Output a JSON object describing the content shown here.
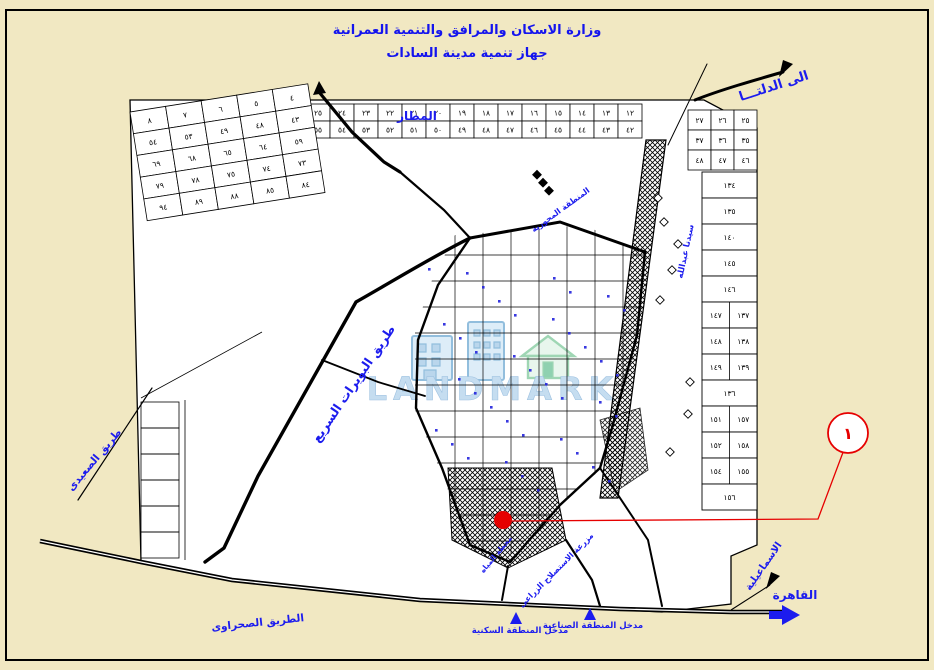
{
  "colors": {
    "bg": "#f1e8c2",
    "line": "#000000",
    "label": "#1c1cee",
    "title": "#1414ee",
    "red": "#e60000",
    "watermark_blue": "#aecfe9",
    "watermark_blue_stroke": "#7fb3d8",
    "watermark_green": "#7cc9a3"
  },
  "header": {
    "line1": "وزارة الاسكان والمرافق والتنمية العمرانية",
    "line2": "جهاز تنمية مدينة السادات"
  },
  "watermark": {
    "text": "LANDMARK"
  },
  "marker": {
    "dot": {
      "x": 503,
      "y": 520,
      "r": 9
    },
    "leader": [
      [
        512,
        521
      ],
      [
        818,
        519
      ],
      [
        845,
        447
      ]
    ],
    "circle": {
      "x": 848,
      "y": 433,
      "r": 20,
      "label": "١"
    }
  },
  "map": {
    "labels": [
      {
        "id": "airport",
        "text": "المطار",
        "x": 417,
        "y": 120,
        "size": 12,
        "rotate": 0
      },
      {
        "id": "to-delta",
        "text": "الى الدلتـــا",
        "x": 775,
        "y": 90,
        "size": 13,
        "rotate": -18
      },
      {
        "id": "cairo",
        "text": "القاهرة",
        "x": 795,
        "y": 599,
        "size": 12,
        "rotate": 0
      },
      {
        "id": "ismailia",
        "text": "الاسماعيلية",
        "x": 766,
        "y": 568,
        "size": 10,
        "rotate": -55
      },
      {
        "id": "desert-road",
        "text": "الطريق الصحراوى",
        "x": 258,
        "y": 626,
        "size": 10.5,
        "rotate": -6
      },
      {
        "id": "saeedi-road",
        "text": "طريق الصعيدى",
        "x": 97,
        "y": 462,
        "size": 10.5,
        "rotate": -50
      },
      {
        "id": "buwayrat-road",
        "text": "طريق البويرات السريع",
        "x": 357,
        "y": 386,
        "size": 12.5,
        "rotate": -56
      },
      {
        "id": "central-zone",
        "text": "المنطقة المحورية",
        "x": 562,
        "y": 212,
        "size": 8,
        "rotate": -36
      },
      {
        "id": "water-station",
        "text": "محطة المياه",
        "x": 498,
        "y": 556,
        "size": 7.5,
        "rotate": -50
      },
      {
        "id": "reclamation-farm",
        "text": "مزرعة الاستصلاح الزراعى",
        "x": 558,
        "y": 572,
        "size": 8,
        "rotate": -45
      },
      {
        "id": "residential-entrance",
        "text": "مدخل المنطقة السكنية",
        "x": 520,
        "y": 633,
        "size": 8.5,
        "rotate": 0
      },
      {
        "id": "industrial-entrance",
        "text": "مدخل المنطقة الصناعية",
        "x": 593,
        "y": 628,
        "size": 8.5,
        "rotate": 0
      },
      {
        "id": "sidna-abdallah",
        "text": "سيدنا عبدالله",
        "x": 688,
        "y": 252,
        "size": 8.5,
        "rotate": -78
      }
    ],
    "grids": {
      "top_strip": {
        "x": 306,
        "y": 104,
        "cw": 24,
        "ch": 17,
        "rotate": 0,
        "rows": [
          [
            "٢٥",
            "٢٤",
            "٢٣",
            "٢٢",
            "٢١",
            "٢٠",
            "١٩",
            "١٨",
            "١٧",
            "١٦",
            "١٥",
            "١٤",
            "١٣",
            "١٢"
          ],
          [
            "٥٥",
            "٥٤",
            "٥٣",
            "٥٢",
            "٥١",
            "٥٠",
            "٤٩",
            "٤٨",
            "٤٧",
            "٤٦",
            "٤٥",
            "٤٤",
            "٤٣",
            "٤٢"
          ]
        ]
      },
      "west_block": {
        "x": 130,
        "y": 112,
        "cw": 36,
        "ch": 22,
        "rotate": -9,
        "rows": [
          [
            "٨",
            "٧",
            "٦",
            "٥",
            "٤"
          ],
          [
            "٥٤",
            "٥٣",
            "٤٩",
            "٤٨",
            "٤٣"
          ],
          [
            "٦٩",
            "٦٨",
            "٦٥",
            "٦٤",
            "٥٩"
          ],
          [
            "٧٩",
            "٧٨",
            "٧٥",
            "٧٤",
            "٧٣"
          ],
          [
            "٩٤",
            "٨٩",
            "٨٨",
            "٨٥",
            "٨٤"
          ]
        ]
      },
      "northeast_block": {
        "x": 688,
        "y": 110,
        "cw": 23,
        "ch": 20,
        "rotate": 0,
        "rows": [
          [
            "٢٧",
            "٢٦",
            "٢٥"
          ],
          [
            "٣٧",
            "٣٦",
            "٣٥"
          ],
          [
            "٤٨",
            "٤٧",
            "٤٦"
          ]
        ]
      },
      "east_column": {
        "x": 702,
        "y": 172,
        "w": 55,
        "h": 26,
        "cells": [
          [
            "١٣٤"
          ],
          [
            "١٣٥"
          ],
          [
            "١٤٠"
          ],
          [
            "١٤٥"
          ],
          [
            "١٤٦"
          ],
          [
            "١٤٧",
            "١٣٧"
          ],
          [
            "١٤٨",
            "١٣٨"
          ],
          [
            "١٤٩",
            "١٣٩"
          ],
          [
            "١٣٦"
          ],
          [
            "١٥١",
            "١٥٧"
          ],
          [
            "١٥٢",
            "١٥٨"
          ],
          [
            "١٥٤",
            "١٥٥"
          ],
          [
            "١٥٦"
          ]
        ]
      }
    }
  }
}
